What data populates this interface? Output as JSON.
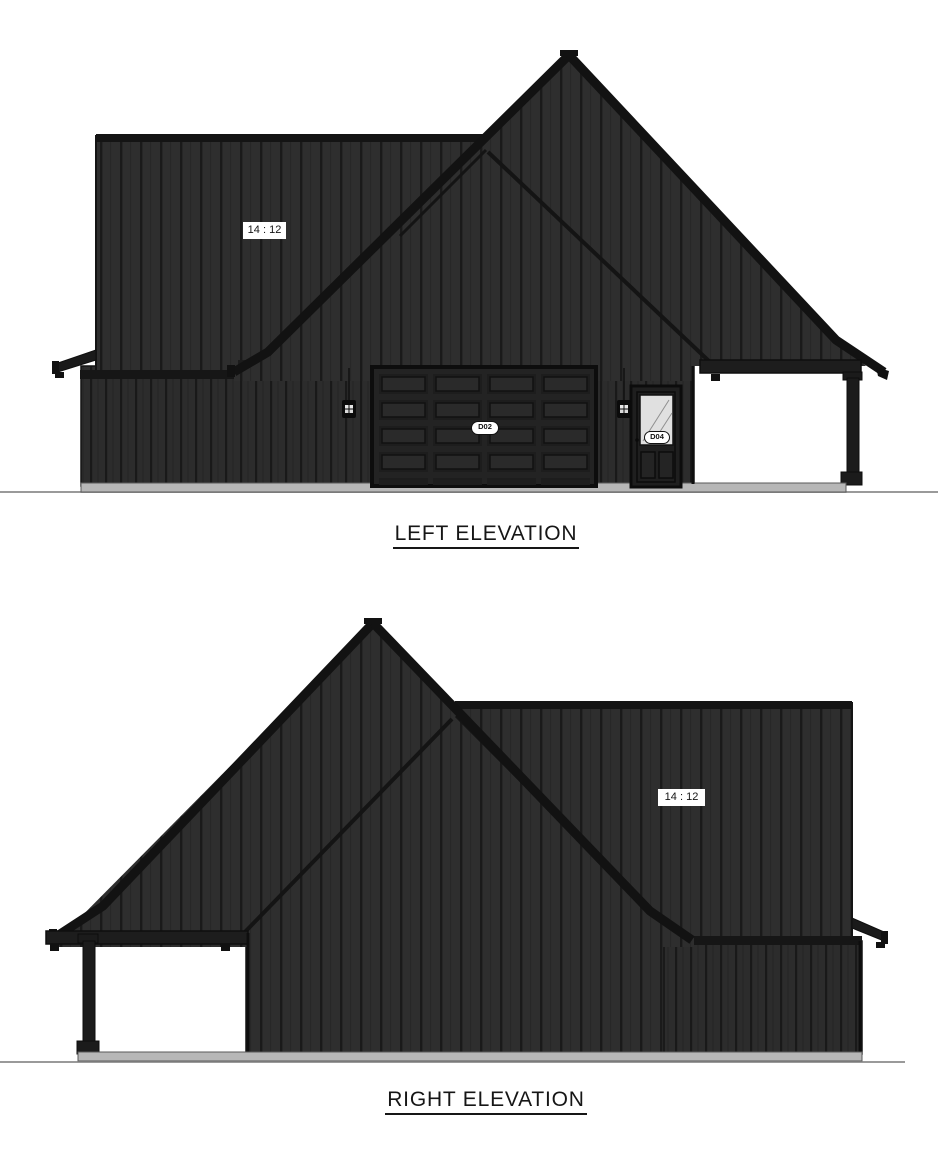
{
  "sheet": {
    "background": "#ffffff"
  },
  "left_elevation": {
    "title": "LEFT ELEVATION",
    "pitch_label": "14 : 12",
    "garage_door_label": "D02",
    "entry_door_label": "D04"
  },
  "right_elevation": {
    "title": "RIGHT ELEVATION",
    "pitch_label": "14 : 12"
  },
  "colors": {
    "siding": "#2e2e2e",
    "siding_wall": "#2c2c2c",
    "batten": "#1a1a1a",
    "trim": "#141414",
    "fascia": "#121212",
    "foundation": "#b7b7b7",
    "ground_line": "#9a9a9a",
    "glass": "#e0e0e0",
    "label_background": "#ffffff",
    "text": "#111111"
  }
}
